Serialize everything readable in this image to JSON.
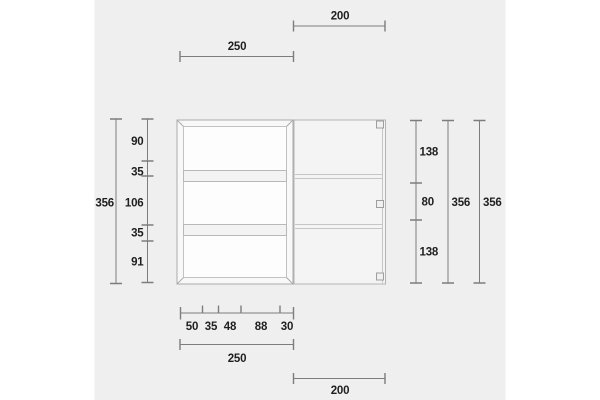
{
  "colors": {
    "panel_bg": "#efefef",
    "dim_line": "#7d7d7d",
    "text": "#1f1f1f",
    "frame_stroke": "#ababab",
    "frame_fill": "#f8f8f8",
    "interior_fill": "#fdfdfd",
    "interior_stroke": "#c2c2c2",
    "shelf_fill": "#f3f3f3",
    "shelf_stroke": "#b8b8b8",
    "door_fill": "#f4f4f4",
    "door_stroke": "#b3b3b3",
    "door_line": "#c6c6c6",
    "hinge_fill": "#f0f0f0",
    "hinge_stroke": "#9e9e9e"
  },
  "dimensions": {
    "top_cabinet_width": "250",
    "top_door_width": "200",
    "left_total_height": "356",
    "left_segments": [
      "90",
      "35",
      "106",
      "35",
      "91"
    ],
    "right_segments": [
      "138",
      "80",
      "138"
    ],
    "right_door_height": "356",
    "right_total_height": "356",
    "bottom_segments": [
      "50",
      "35",
      "48",
      "88",
      "30"
    ],
    "bottom_cabinet_width": "250",
    "bottom_door_width": "200"
  }
}
